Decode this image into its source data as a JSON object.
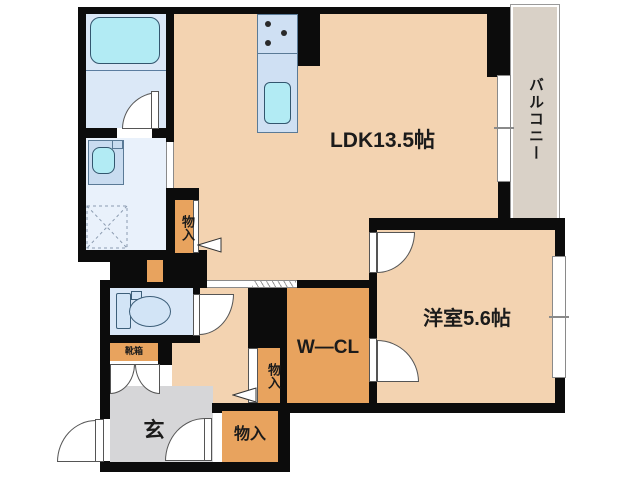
{
  "labels": {
    "ldk": "LDK13.5帖",
    "western_room": "洋室5.6帖",
    "balcony": "バルコニー",
    "walk_in_closet": "W—CL",
    "entrance": "玄",
    "storage_hall": "物入",
    "storage_genkan": "物入",
    "storage_entrance": "物入",
    "shoe_box": "靴箱"
  },
  "colors": {
    "wall": "#0c0c0c",
    "line": "#555555",
    "room_peach": "#f3d3b1",
    "storage_orange": "#e8a35e",
    "bath_blue": "#dbe8f7",
    "washroom_blue": "#e9f1fb",
    "toilet_blue": "#d9e7f7",
    "counter_blue": "#cfe0f3",
    "basin_blue": "#c9dcf0",
    "fixture_cyan": "#b2ebf4",
    "balcony_tan": "#d9d1c7",
    "entrance_gray": "#d6d6d8"
  }
}
